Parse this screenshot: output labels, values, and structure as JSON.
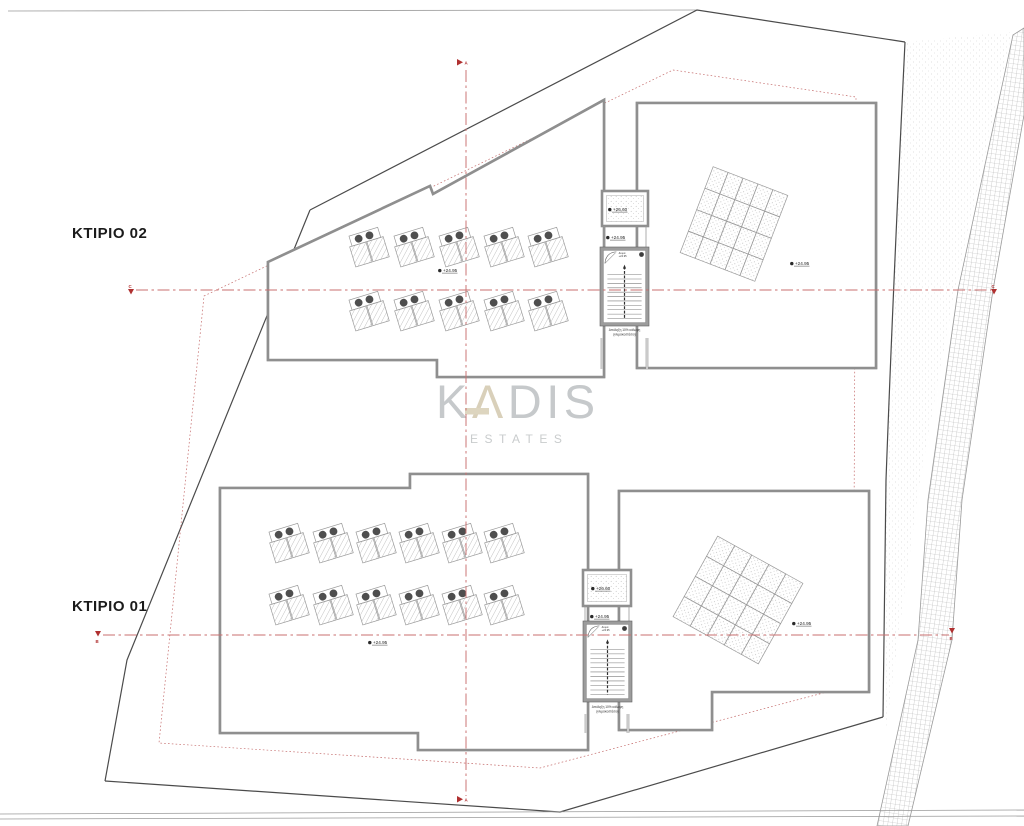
{
  "labels": {
    "building_top": "ΚΤΙΡΙΟ 02",
    "building_bottom": "ΚΤΙΡΙΟ 01"
  },
  "watermark": {
    "k": "K",
    "a": "Λ",
    "dis": "DIS",
    "subtitle": "ESTATES",
    "gray": "#c6c9cb",
    "beige": "#d9d0ba"
  },
  "section_markers": {
    "vertical": "A",
    "upper": "C",
    "lower": "B"
  },
  "levels": [
    {
      "x": 443,
      "y": 272,
      "text": "+24.95"
    },
    {
      "x": 795,
      "y": 265,
      "text": "+24.95"
    },
    {
      "x": 613,
      "y": 211,
      "text": "+26.60"
    },
    {
      "x": 611,
      "y": 239,
      "text": "+24.95"
    },
    {
      "x": 373,
      "y": 644,
      "text": "+24.95"
    },
    {
      "x": 797,
      "y": 625,
      "text": "+24.95"
    },
    {
      "x": 596,
      "y": 590,
      "text": "+26.60"
    },
    {
      "x": 595,
      "y": 618,
      "text": "+24.95"
    }
  ],
  "stair_notes": {
    "top1": "Δώμα",
    "top2": "+24.95",
    "cap1": "Απόληξη 10% κάλυψη",
    "cap2": "(κλιμακοστάσιο)"
  },
  "stairs": [
    {
      "x": 600,
      "y": 247,
      "w": 49,
      "h": 79,
      "capx": 624.5,
      "capy": 331
    },
    {
      "x": 583,
      "y": 621,
      "w": 49,
      "h": 81,
      "capx": 607.5,
      "capy": 708
    }
  ],
  "solar_units": {
    "tilt_deg": -17,
    "building_02": [
      [
        368,
        247
      ],
      [
        413,
        247
      ],
      [
        458,
        247
      ],
      [
        503,
        247
      ],
      [
        547,
        247
      ],
      [
        368,
        311
      ],
      [
        413,
        311
      ],
      [
        458,
        311
      ],
      [
        503,
        311
      ],
      [
        547,
        311
      ]
    ],
    "building_01": [
      [
        288,
        543
      ],
      [
        332,
        543
      ],
      [
        375,
        543
      ],
      [
        418,
        543
      ],
      [
        461,
        543
      ],
      [
        503,
        543
      ],
      [
        288,
        605
      ],
      [
        332,
        605
      ],
      [
        375,
        605
      ],
      [
        418,
        605
      ],
      [
        461,
        605
      ],
      [
        503,
        605
      ]
    ]
  },
  "panel_grids": [
    {
      "cx": 734,
      "cy": 224,
      "cols": 5,
      "rows": 4,
      "cw": 16,
      "ch": 23,
      "rot": 21
    },
    {
      "cx": 738,
      "cy": 600,
      "cols": 5,
      "rows": 4,
      "cw": 19.5,
      "ch": 23,
      "rot": 29
    }
  ],
  "colors": {
    "wall": "#8f8f8f",
    "boundary": "#4b4b4b",
    "section_red": "#c96f6f",
    "setback_red": "#c46a6a",
    "marker_red": "#b03030",
    "ink": "#1b1b1b"
  }
}
